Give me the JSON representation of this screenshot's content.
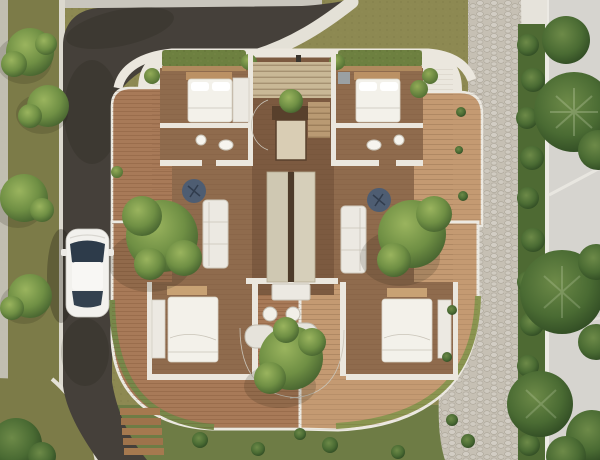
{
  "scene": {
    "type": "architectural-aerial-render",
    "description": "Photorealistic top-down 3D render of a residential villa floor plan: four bedrooms with white beds in the corners, a central entry stair core with plant, two living rooms with white sofas and navy round chairs, bathrooms, curved brick and sandstone terraces with trees, surrounded by an L-curved asphalt road with a white car, grass verges, a cobblestone garden path, hedges and a neighboring building with large trees.",
    "palette": {
      "road": "#45403a",
      "grassOlive": "#8d8952",
      "grassVerge": "#7c7b48",
      "grassLawn": "#6e7c45",
      "sidewalk": "#c7c4bb",
      "curb": "#e4e1d7",
      "wall": "#ebe7de",
      "woodFloor": "#8f6b4d",
      "woodDark": "#7c5a40",
      "brickTerrace": "#a87a58",
      "sandTerrace": "#c49a72",
      "pathStone": "#c6c0b4",
      "hedge": "#4e6a33",
      "neighborRoof": "#d6d4cf",
      "furnitureWhite": "#ece9e2",
      "bedWhite": "#f3f1ea",
      "headboard": "#bb9164",
      "chairNavy": "#4e5d72",
      "stairWood": "#c9b896",
      "coreWood": "#58402c",
      "plantBox": "#6d8040",
      "carBody": "#f2f1ed",
      "carGlass": "#2d3b4a",
      "treeBright": "#6f8f44",
      "treeDark": "#3f5c2d"
    },
    "objects": [
      {
        "name": "asphalt-road",
        "label": "Curved asphalt road"
      },
      {
        "name": "white-car",
        "label": "White car parked on road"
      },
      {
        "name": "villa-building",
        "label": "Villa floor plan with four bedrooms"
      },
      {
        "name": "entry-stairs",
        "label": "Entry staircase with plant core"
      },
      {
        "name": "living-room-left",
        "label": "Left living room: white sofa, navy chair"
      },
      {
        "name": "living-room-right",
        "label": "Right living room: white sofa, navy chair"
      },
      {
        "name": "bathrooms",
        "label": "Bathrooms with round fixtures"
      },
      {
        "name": "terraces",
        "label": "Curved brick and sandstone terraces"
      },
      {
        "name": "garden-path",
        "label": "Cobblestone garden path"
      },
      {
        "name": "neighbor-building",
        "label": "Neighboring building with tall trees"
      },
      {
        "name": "garden-steps",
        "label": "Wooden garden steps"
      },
      {
        "name": "trees",
        "label": "Courtyard and street trees"
      }
    ]
  }
}
